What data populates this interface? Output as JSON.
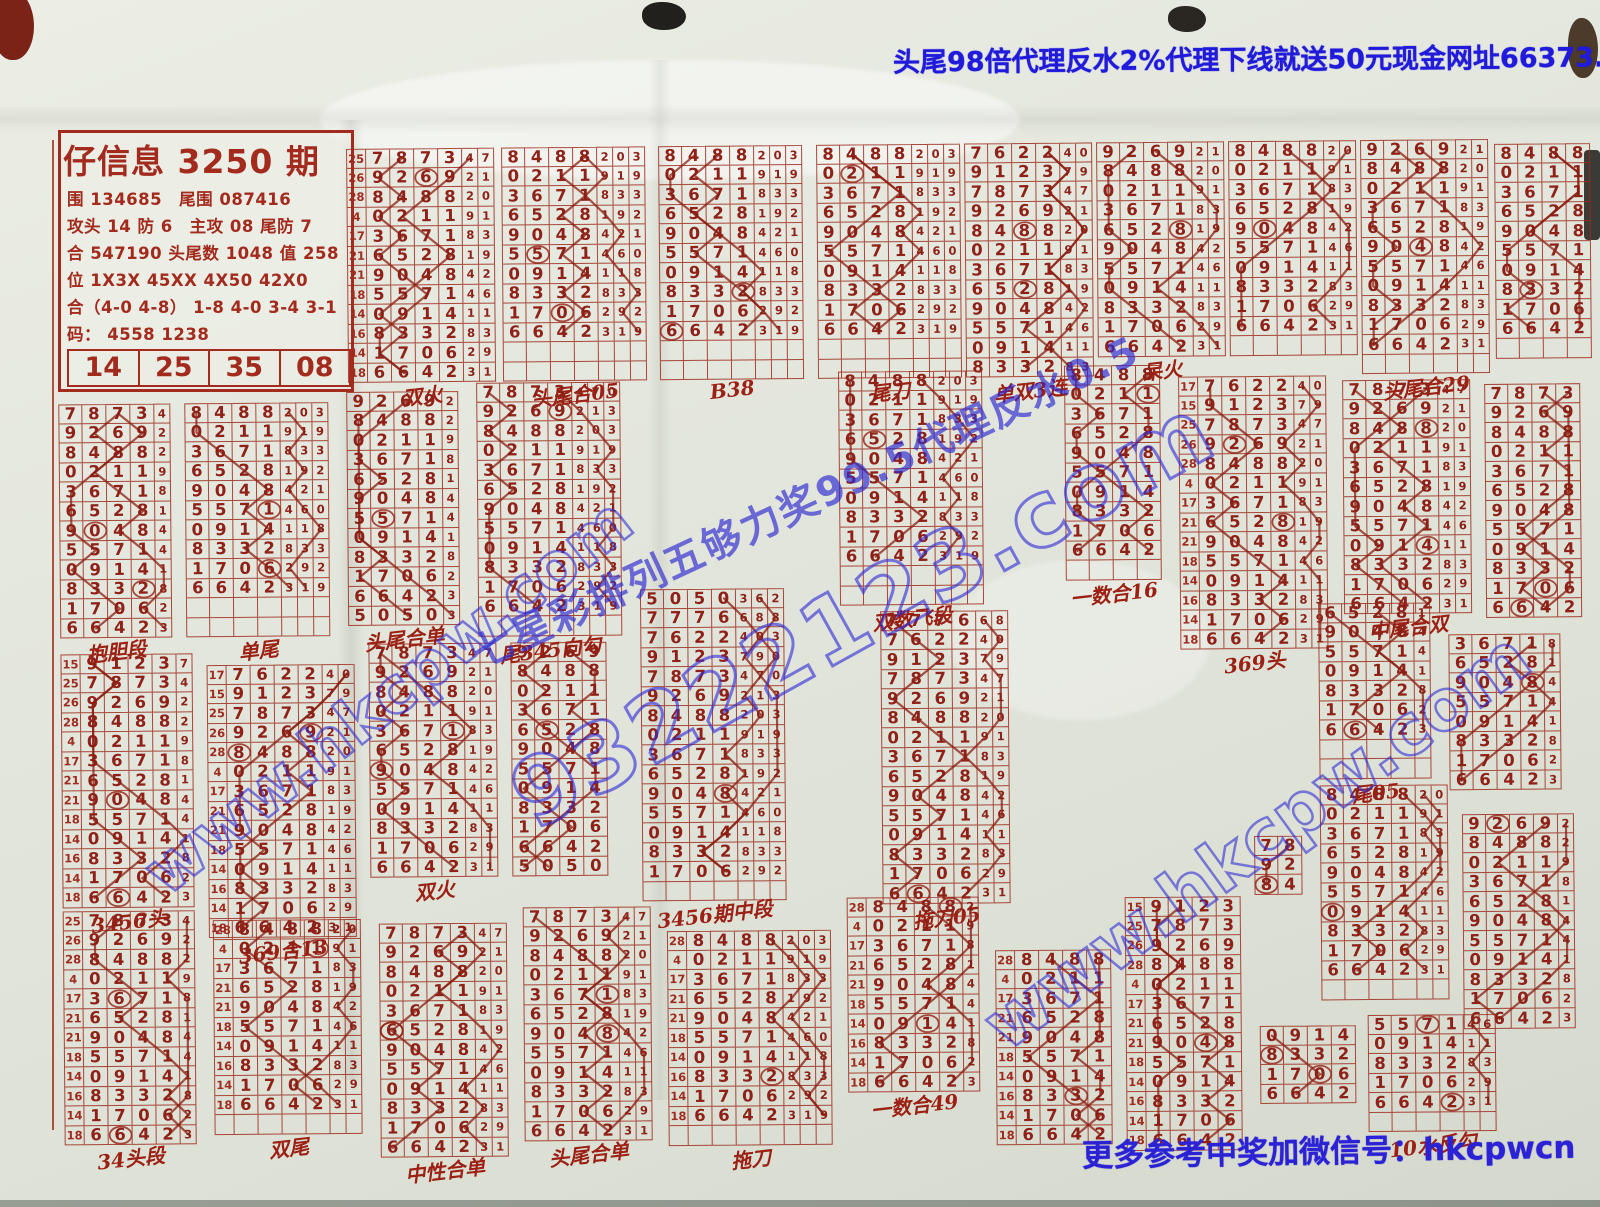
{
  "header": {
    "promo": "头尾98倍代理反水2%代理下线就送50元现金网址66373.com"
  },
  "footer": {
    "note": "更多参考中奖加微信号：hkcpwcn"
  },
  "watermarks": {
    "big": "93222123.com",
    "site": "www.hkcpw.com",
    "diag": "七星彩排列五够力奖99.5代理反水0.5"
  },
  "info_box": {
    "title": "仔信息 3250 期",
    "lines": [
      "围 134685　尾围 087416",
      "攻头 14 防 6　主攻 08 尾防 7",
      "合 547190 头尾数 1048 值 258",
      "位 1X3X 45XX 4X50 42X0",
      "合（4-0 4-8） 1-8 4-0 3-4 3-1",
      "码： 4558 1238"
    ],
    "picks": [
      "14",
      "25",
      "35",
      "08"
    ],
    "bottom": [
      "0 — 254179",
      "58 — 176920　147 — 147269"
    ]
  },
  "colors": {
    "ink_red": "#9e2a1c",
    "ink_blue": "#2a22d4",
    "paper": "#e3e6dc"
  },
  "grid": {
    "master_rows": [
      "5050362",
      "7776688",
      "7622403",
      "9123790",
      "7873470",
      "9269213",
      "8488203",
      "0211919",
      "3671833",
      "6528192",
      "9048421",
      "5571460",
      "0914118",
      "8332833",
      "1706292",
      "6642319"
    ],
    "gutter_labels": [
      "17",
      "15",
      "25",
      "26",
      "28",
      "4",
      "17",
      "21",
      "21",
      "18",
      "14",
      "16",
      "14",
      "18"
    ],
    "blocks": [
      {
        "x": 350,
        "y": 145,
        "s": 4,
        "c": 12,
        "nd": 6,
        "g": 1,
        "e": 0,
        "l": "双火"
      },
      {
        "x": 505,
        "y": 145,
        "s": 6,
        "c": 10,
        "nd": 7,
        "g": 0,
        "e": 2,
        "l": "头尾合05"
      },
      {
        "x": 662,
        "y": 145,
        "s": 6,
        "c": 10,
        "nd": 7,
        "g": 0,
        "e": 2,
        "l": "B38"
      },
      {
        "x": 820,
        "y": 145,
        "s": 6,
        "c": 10,
        "nd": 7,
        "g": 0,
        "e": 2,
        "l": "尾刀"
      },
      {
        "x": 968,
        "y": 145,
        "s": 2,
        "c": 12,
        "nd": 6,
        "g": 0,
        "e": 0,
        "l": "单双3连"
      },
      {
        "x": 1100,
        "y": 145,
        "s": 5,
        "c": 11,
        "nd": 6,
        "g": 0,
        "e": 0,
        "l": "呆火"
      },
      {
        "x": 1232,
        "y": 145,
        "s": 6,
        "c": 10,
        "nd": 6,
        "g": 0,
        "e": 1,
        "l": ""
      },
      {
        "x": 1364,
        "y": 145,
        "s": 5,
        "c": 11,
        "nd": 6,
        "g": 0,
        "e": 1,
        "l": "头尾合29"
      },
      {
        "x": 1498,
        "y": 150,
        "s": 6,
        "c": 10,
        "nd": 4,
        "g": 0,
        "e": 1,
        "l": ""
      },
      {
        "x": 60,
        "y": 398,
        "s": 4,
        "c": 12,
        "nd": 5,
        "g": 0,
        "e": 0,
        "l": "抱胆段"
      },
      {
        "x": 186,
        "y": 398,
        "s": 6,
        "c": 10,
        "nd": 7,
        "g": 0,
        "e": 2,
        "l": "单尾"
      },
      {
        "x": 348,
        "y": 388,
        "s": 5,
        "c": 12,
        "nd": 5,
        "g": 0,
        "e": 0,
        "l": "头尾合单"
      },
      {
        "x": 478,
        "y": 380,
        "s": 4,
        "c": 12,
        "nd": 7,
        "g": 0,
        "e": 1,
        "l": "尾345向勾"
      },
      {
        "x": 640,
        "y": 588,
        "s": 0,
        "c": 15,
        "nd": 7,
        "g": 0,
        "e": 1,
        "l": "3456期中段"
      },
      {
        "x": 840,
        "y": 372,
        "s": 6,
        "c": 10,
        "nd": 7,
        "g": 0,
        "e": 2,
        "l": "双数飞段"
      },
      {
        "x": 880,
        "y": 612,
        "s": 1,
        "c": 15,
        "nd": 6,
        "g": 0,
        "e": 0,
        "l": "拖刀05"
      },
      {
        "x": 1066,
        "y": 368,
        "s": 6,
        "c": 10,
        "nd": 4,
        "g": 0,
        "e": 1,
        "l": "一数合16"
      },
      {
        "x": 1180,
        "y": 380,
        "s": 2,
        "c": 14,
        "nd": 6,
        "g": 1,
        "e": 0,
        "l": "369头"
      },
      {
        "x": 1344,
        "y": 385,
        "s": 4,
        "c": 12,
        "nd": 6,
        "g": 0,
        "e": 0,
        "l": "中尾合双"
      },
      {
        "x": 1486,
        "y": 390,
        "s": 4,
        "c": 12,
        "nd": 4,
        "g": 0,
        "e": 0,
        "l": ""
      },
      {
        "x": 60,
        "y": 648,
        "s": 3,
        "c": 13,
        "nd": 5,
        "g": 1,
        "e": 0,
        "l": "3456头"
      },
      {
        "x": 206,
        "y": 660,
        "s": 2,
        "c": 14,
        "nd": 6,
        "g": 1,
        "e": 0,
        "l": "369合13"
      },
      {
        "x": 368,
        "y": 640,
        "s": 4,
        "c": 12,
        "nd": 6,
        "g": 0,
        "e": 0,
        "l": "双火"
      },
      {
        "x": 510,
        "y": 640,
        "s": 5,
        "c": 12,
        "nd": 4,
        "g": 0,
        "e": 0,
        "l": ""
      },
      {
        "x": 1318,
        "y": 608,
        "s": 9,
        "c": 7,
        "nd": 5,
        "g": 0,
        "e": 2,
        "l": "尾05"
      },
      {
        "x": 1448,
        "y": 640,
        "s": 8,
        "c": 8,
        "nd": 5,
        "g": 0,
        "e": 0,
        "l": ""
      },
      {
        "x": 1318,
        "y": 790,
        "s": 6,
        "c": 10,
        "nd": 6,
        "g": 0,
        "e": 1,
        "l": ""
      },
      {
        "x": 1460,
        "y": 820,
        "s": 5,
        "c": 11,
        "nd": 5,
        "g": 0,
        "e": 0,
        "l": ""
      },
      {
        "x": 60,
        "y": 905,
        "s": 4,
        "c": 12,
        "nd": 5,
        "g": 1,
        "e": 0,
        "l": "34头段"
      },
      {
        "x": 210,
        "y": 915,
        "s": 6,
        "c": 10,
        "nd": 6,
        "g": 1,
        "e": 1,
        "l": "双尾"
      },
      {
        "x": 376,
        "y": 920,
        "s": 4,
        "c": 12,
        "nd": 6,
        "g": 0,
        "e": 0,
        "l": "中性合单"
      },
      {
        "x": 520,
        "y": 905,
        "s": 4,
        "c": 12,
        "nd": 6,
        "g": 0,
        "e": 0,
        "l": "头尾合单"
      },
      {
        "x": 664,
        "y": 930,
        "s": 6,
        "c": 10,
        "nd": 7,
        "g": 1,
        "e": 1,
        "l": "拖刀"
      },
      {
        "x": 844,
        "y": 898,
        "s": 6,
        "c": 10,
        "nd": 5,
        "g": 1,
        "e": 0,
        "l": "一数合49"
      },
      {
        "x": 992,
        "y": 952,
        "s": 6,
        "c": 10,
        "nd": 4,
        "g": 1,
        "e": 0,
        "l": ""
      },
      {
        "x": 1122,
        "y": 900,
        "s": 3,
        "c": 13,
        "nd": 4,
        "g": 1,
        "e": 0,
        "l": ""
      },
      {
        "x": 1252,
        "y": 840,
        "s": 4,
        "c": 3,
        "nd": 2,
        "g": 0,
        "e": 0,
        "l": ""
      },
      {
        "x": 1256,
        "y": 1030,
        "s": 12,
        "c": 4,
        "nd": 4,
        "g": 0,
        "e": 0,
        "l": ""
      },
      {
        "x": 1364,
        "y": 1020,
        "s": 11,
        "c": 5,
        "nd": 6,
        "g": 0,
        "e": 1,
        "l": "10水反勾"
      }
    ]
  }
}
